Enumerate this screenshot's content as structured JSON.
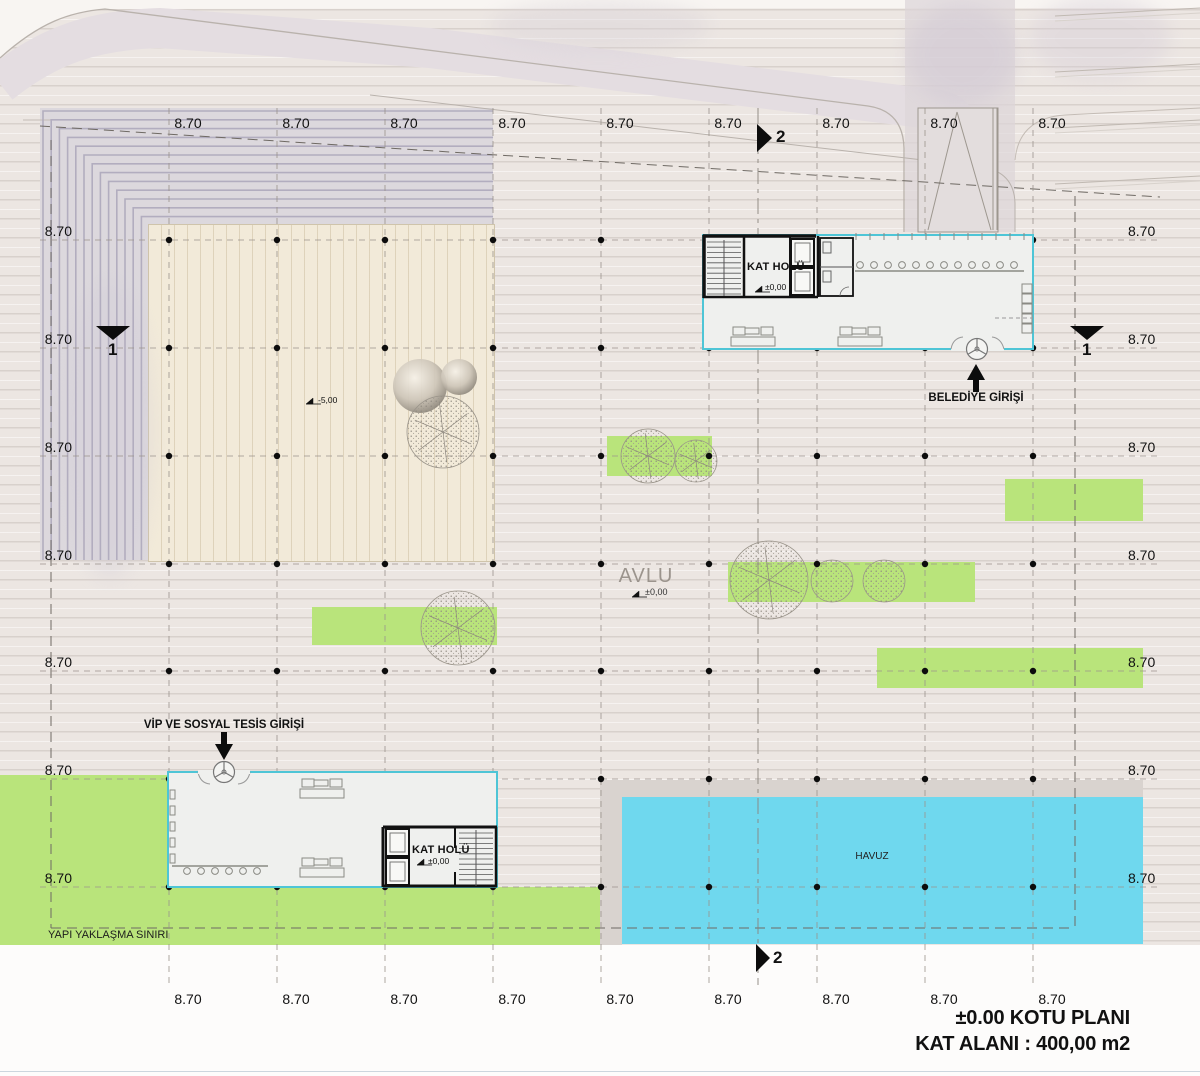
{
  "grid": {
    "dim_label": "8.70"
  },
  "section_markers": {
    "one": "1",
    "two": "2"
  },
  "site": {
    "courtyard_label": "AVLU",
    "courtyard_level": "±0,00",
    "amphitheater_level": "-5,00",
    "pool_label": "HAVUZ",
    "setback_label": "YAPI YAKLAŞMA SINIRI"
  },
  "buildings": {
    "belediye": {
      "hall_label": "KAT HOLÜ",
      "hall_level": "±0,00",
      "entrance_label": "BELEDİYE GİRİŞİ"
    },
    "vip": {
      "hall_label": "KAT HOLÜ",
      "hall_level": "±0,00",
      "entrance_label": "VİP VE SOSYAL TESİS GİRİŞİ"
    }
  },
  "titleblock": {
    "line1": "±0.00 KOTU PLANI",
    "line2": "KAT ALANI : 400,00 m2"
  },
  "colors": {
    "lawn_green": "#b9e47b",
    "pool_cyan": "#6fd8ee",
    "glazing_cyan": "#4ec5d6",
    "step_hatch": "#b2adbf",
    "deck_wood": "#f2ead9",
    "grid_dot": "#0c0c0c"
  }
}
